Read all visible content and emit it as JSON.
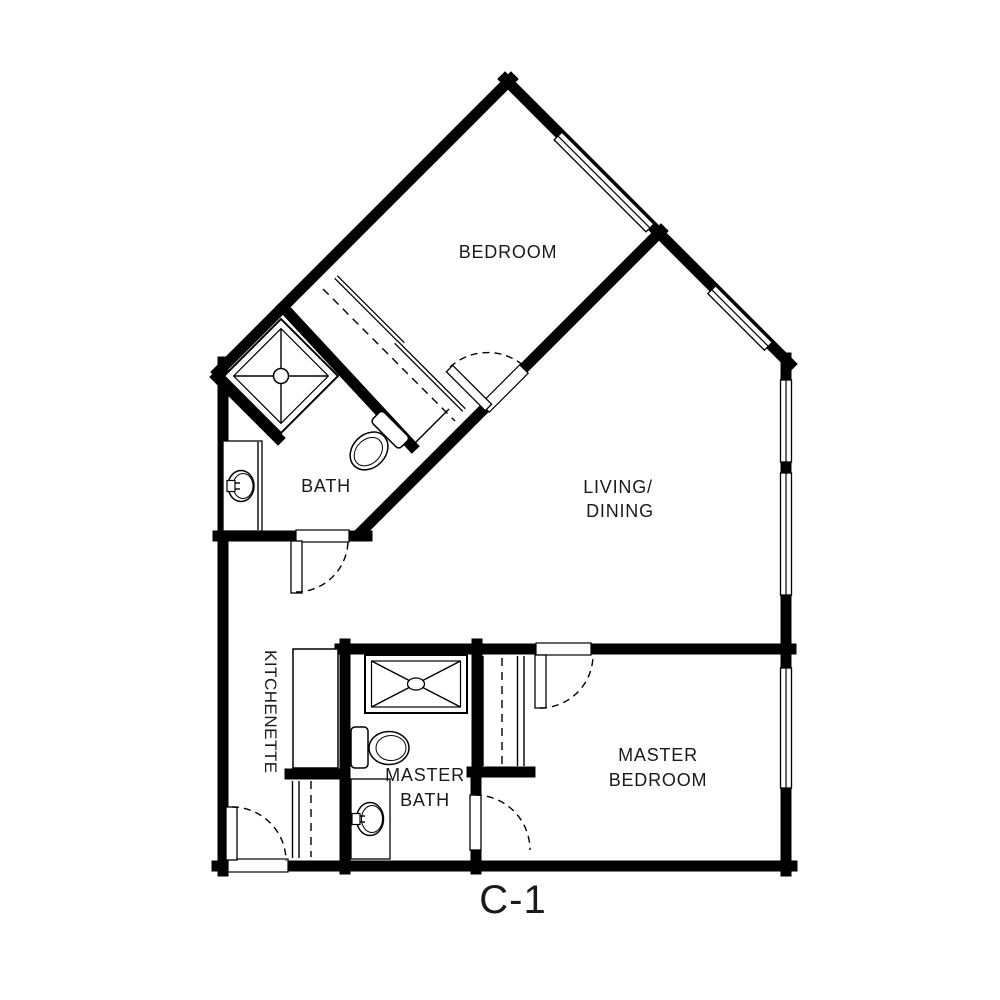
{
  "floor_plan": {
    "unit_label": "C-1",
    "rooms": {
      "bedroom": {
        "label": "BEDROOM"
      },
      "living_dining": {
        "line1": "LIVING/",
        "line2": "DINING"
      },
      "bath": {
        "label": "BATH"
      },
      "kitchenette": {
        "label": "KITCHENETTE"
      },
      "master_bath": {
        "line1": "MASTER",
        "line2": "BATH"
      },
      "master_bedroom": {
        "line1": "MASTER",
        "line2": "BEDROOM"
      }
    },
    "colors": {
      "walls": "#000000",
      "floor": "#ffffff",
      "background": "#ffffff",
      "text": "#1a1a1a"
    },
    "fixtures": [
      "corner-shower",
      "bath-toilet",
      "bath-sink-vanity",
      "bedroom-sliding-closet",
      "kitchenette-counter",
      "master-shower",
      "master-toilet",
      "master-sink-vanity",
      "master-sliding-closet",
      "entry-closet"
    ],
    "doors": [
      "entry-door",
      "bath-door",
      "bedroom-door",
      "master-bedroom-door",
      "master-bath-door"
    ],
    "windows_count": 5
  }
}
